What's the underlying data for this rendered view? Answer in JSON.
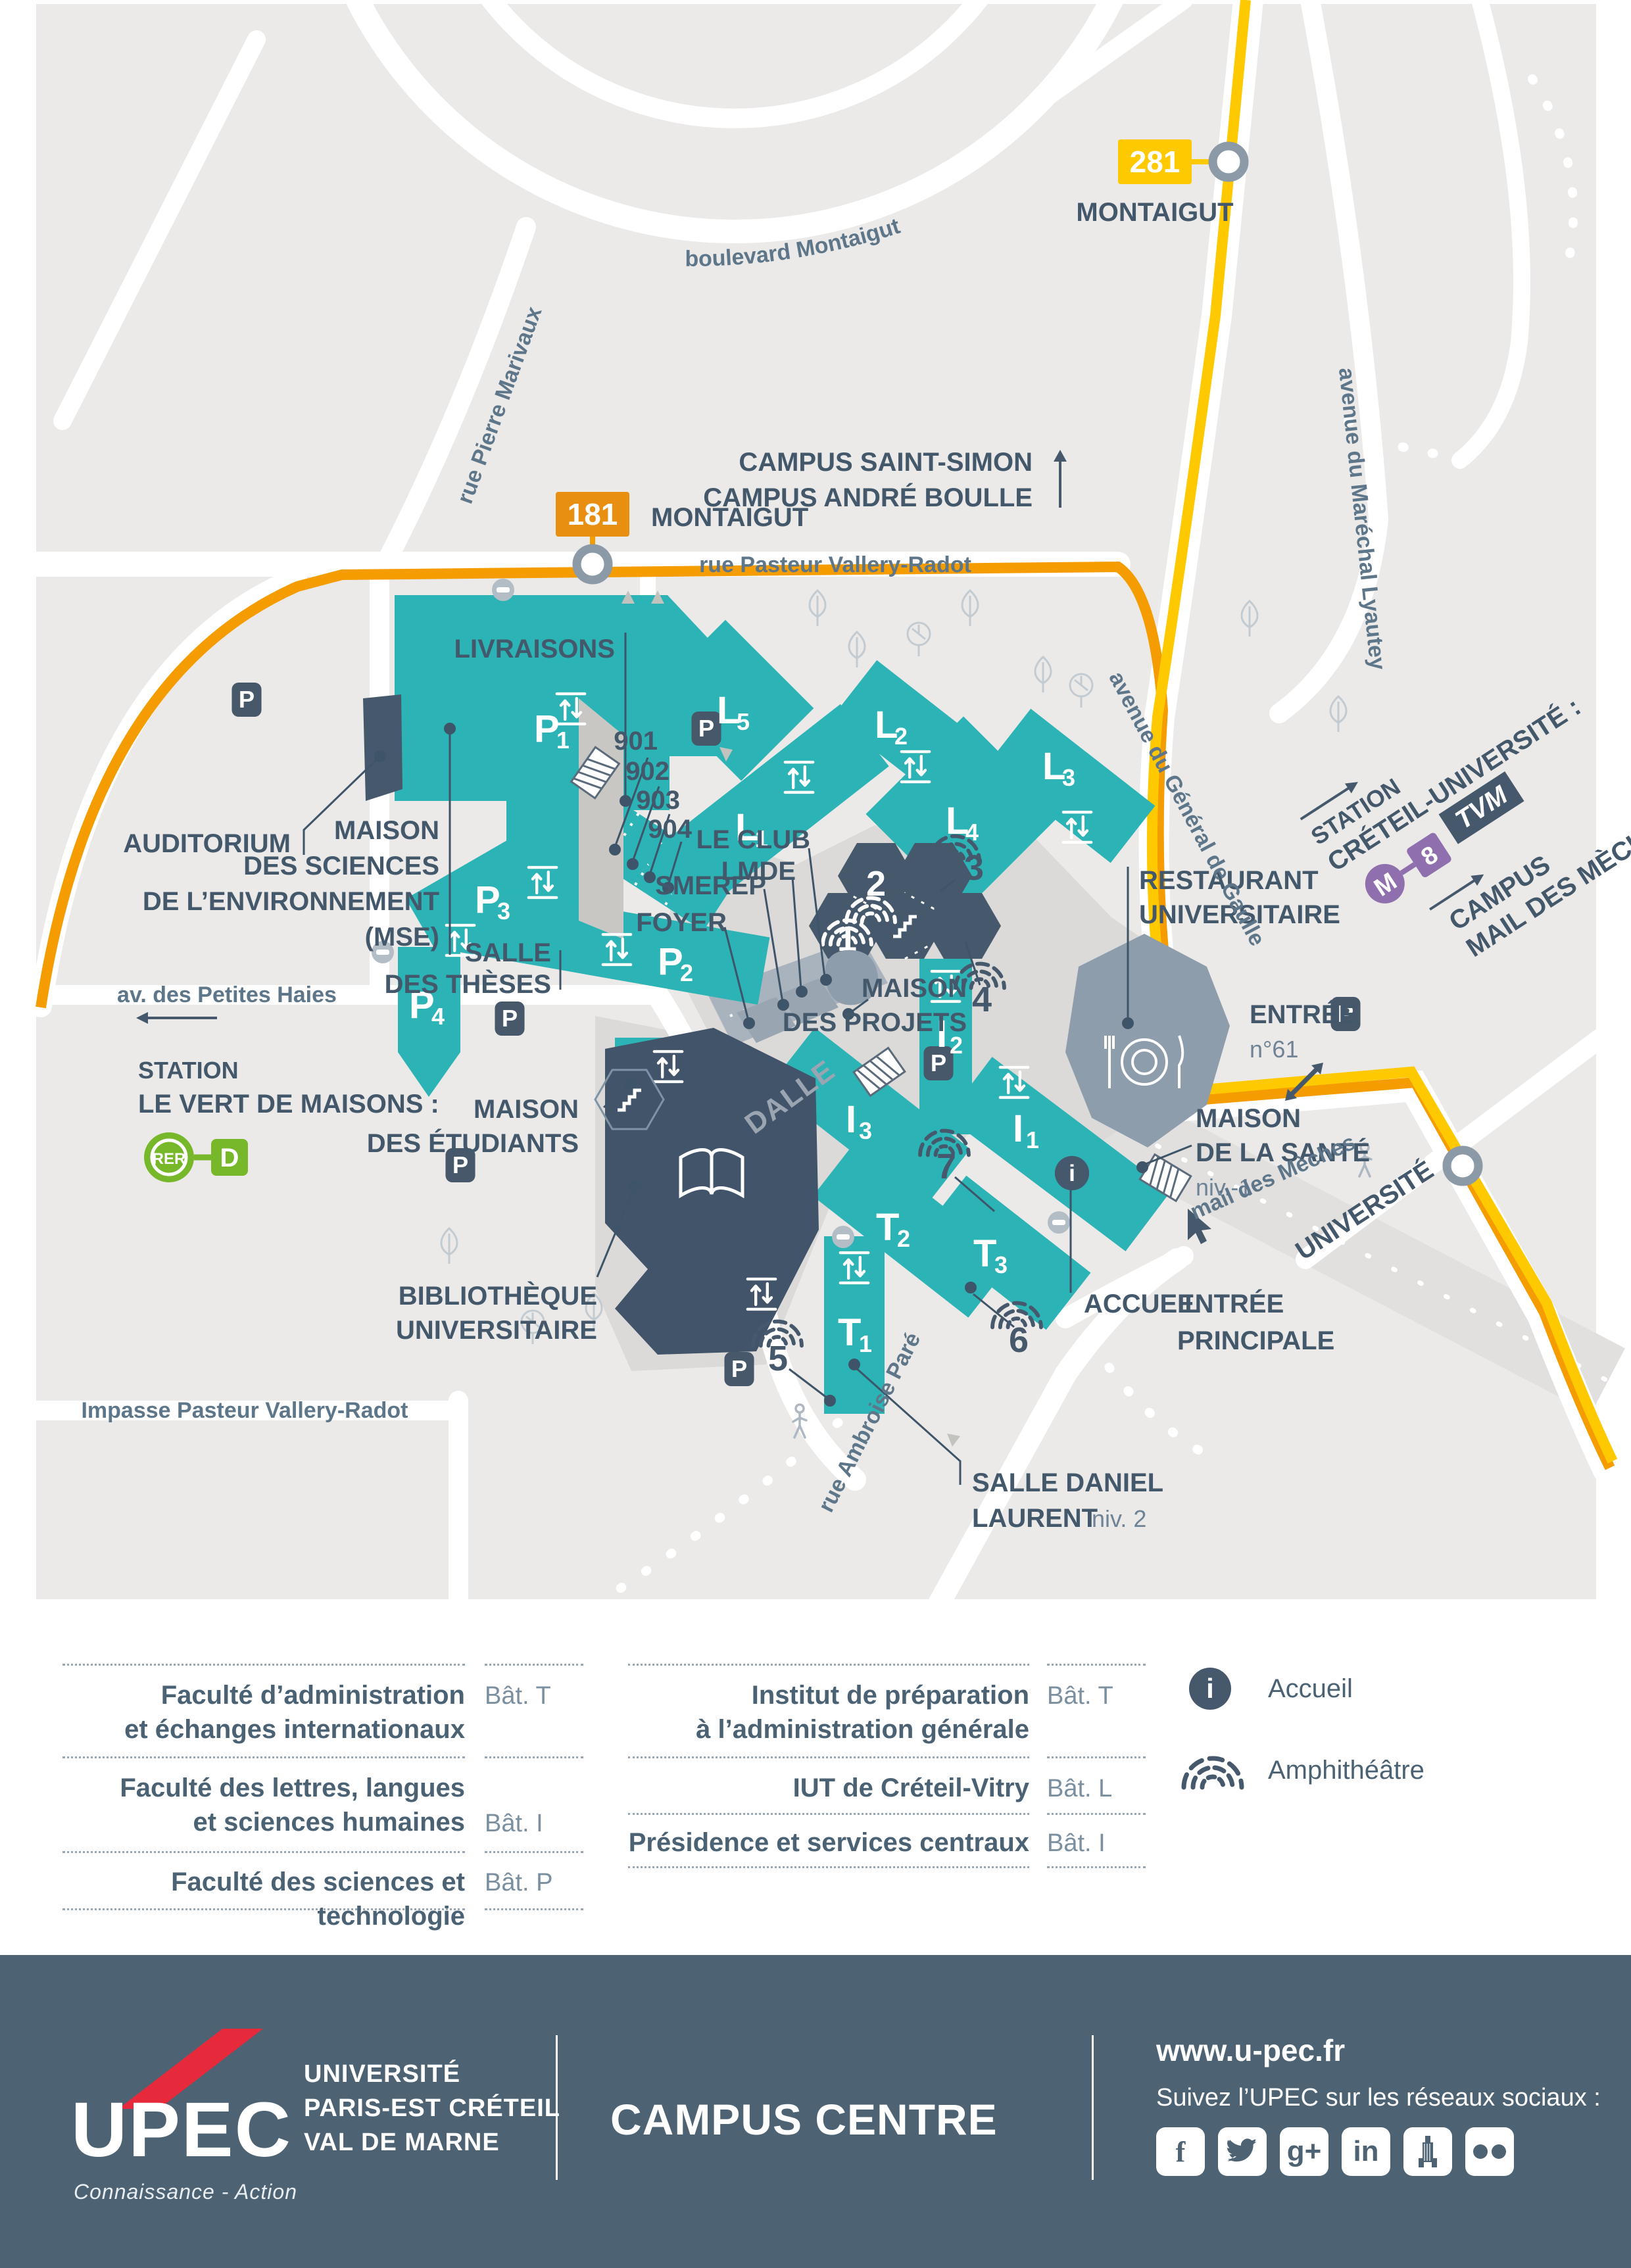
{
  "icons": {
    "parking_letter": "P",
    "info_letter": "i"
  },
  "map": {
    "stops": {
      "s281": {
        "line": "281",
        "name": "MONTAIGUT"
      },
      "s181": {
        "line": "181",
        "name": "MONTAIGUT"
      },
      "universite": "UNIVERSITÉ"
    },
    "directions": {
      "north_l1": "CAMPUS SAINT-SIMON",
      "north_l2": "CAMPUS ANDRÉ BOULLE",
      "creteil": {
        "l1": "STATION",
        "l2": "CRÉTEIL-UNIVERSITÉ :",
        "metro": "M",
        "line8": "8",
        "tvm": "TVM"
      },
      "mail": {
        "l1": "CAMPUS",
        "l2": "MAIL DES MÈCHES"
      },
      "vert": {
        "l1": "STATION",
        "l2": "LE VERT DE MAISONS :",
        "rer": "RER",
        "lined": "D"
      }
    },
    "streets": {
      "montaigut": "boulevard Montaigut",
      "marivaux": "rue Pierre Marivaux",
      "pvr": "rue Pasteur Vallery-Radot",
      "lyautey": "avenue du Maréchal Lyautey",
      "gaulle": "avenue du Général de Gaulle",
      "haies": "av. des Petites Haies",
      "impasse": "Impasse Pasteur Vallery-Radot",
      "ambroise": "rue Ambroise Paré",
      "mail": "mail des Mèches"
    },
    "buildings": {
      "p1": {
        "l": "P",
        "n": "1"
      },
      "p2": {
        "l": "P",
        "n": "2"
      },
      "p3": {
        "l": "P",
        "n": "3"
      },
      "p4": {
        "l": "P",
        "n": "4"
      },
      "l1": {
        "l": "L",
        "n": "1"
      },
      "l2": {
        "l": "L",
        "n": "2"
      },
      "l3": {
        "l": "L",
        "n": "3"
      },
      "l4": {
        "l": "L",
        "n": "4"
      },
      "l5": {
        "l": "L",
        "n": "5"
      },
      "i1": {
        "l": "I",
        "n": "1"
      },
      "i2": {
        "l": "I",
        "n": "2"
      },
      "i3": {
        "l": "I",
        "n": "3"
      },
      "t1": {
        "l": "T",
        "n": "1"
      },
      "t2": {
        "l": "T",
        "n": "2"
      },
      "t3": {
        "l": "T",
        "n": "3"
      }
    },
    "amphis": [
      "1",
      "2",
      "3",
      "4",
      "5",
      "6",
      "7"
    ],
    "rooms": [
      "901",
      "902",
      "903",
      "904"
    ],
    "pois": {
      "livraisons": "LIVRAISONS",
      "auditorium": "AUDITORIUM",
      "mse": {
        "l1": "MAISON",
        "l2": "DES SCIENCES",
        "l3": "DE L’ENVIRONNEMENT",
        "l4": "(MSE)"
      },
      "club": {
        "l1": "LE CLUB",
        "l2": "LMDE"
      },
      "smerep": "SMEREP",
      "foyer": "FOYER",
      "theses": {
        "l1": "SALLE",
        "l2": "DES THÈSES"
      },
      "mde": {
        "l1": "MAISON",
        "l2": "DES ÉTUDIANTS"
      },
      "bu": {
        "l1": "BIBLIOTHÈQUE",
        "l2": "UNIVERSITAIRE"
      },
      "projets": {
        "l1": "MAISON",
        "l2": "DES PROJETS"
      },
      "dalle": "DALLE",
      "ru": {
        "l1": "RESTAURANT",
        "l2": "UNIVERSITAIRE"
      },
      "entree61": {
        "l1": "ENTRÉE",
        "l2": "n°61"
      },
      "sante": {
        "l1": "MAISON",
        "l2": "DE LA SANTÉ",
        "l3": "niv.-1"
      },
      "accueil": "ACCUEIL",
      "principale": {
        "l1": "ENTRÉE",
        "l2": "PRINCIPALE"
      },
      "daniel": {
        "l1": "SALLE DANIEL",
        "l2": "LAURENT",
        "l2b": "niv. 2"
      }
    }
  },
  "legend": {
    "col1": [
      {
        "l1": "Faculté d’administration",
        "l2": "et échanges internationaux",
        "bat": "Bât. T"
      },
      {
        "l1": "Faculté des lettres, langues",
        "l2": "et sciences humaines",
        "bat": "Bât. I"
      },
      {
        "l1": "Faculté des sciences et technologie",
        "l2": "",
        "bat": "Bât. P"
      }
    ],
    "col2": [
      {
        "l1": "Institut de préparation",
        "l2": "à l’administration générale",
        "bat": "Bât. T"
      },
      {
        "l1": "IUT de Créteil-Vitry",
        "l2": "",
        "bat": "Bât. L"
      },
      {
        "l1": "Présidence et services centraux",
        "l2": "",
        "bat": "Bât. I"
      }
    ],
    "icon_items": [
      {
        "label": "Accueil"
      },
      {
        "label": "Amphithéâtre"
      }
    ]
  },
  "footer": {
    "upec": "UPEC",
    "tagline": "Connaissance - Action",
    "uni_l1": "UNIVERSITÉ",
    "uni_l2": "PARIS-EST CRÉTEIL",
    "uni_l3": "VAL DE MARNE",
    "campus": "CAMPUS CENTRE",
    "site": "www.u-pec.fr",
    "social": "Suivez l’UPEC sur les réseaux sociaux :",
    "fb": "f",
    "gp": "g+",
    "in": "in"
  }
}
